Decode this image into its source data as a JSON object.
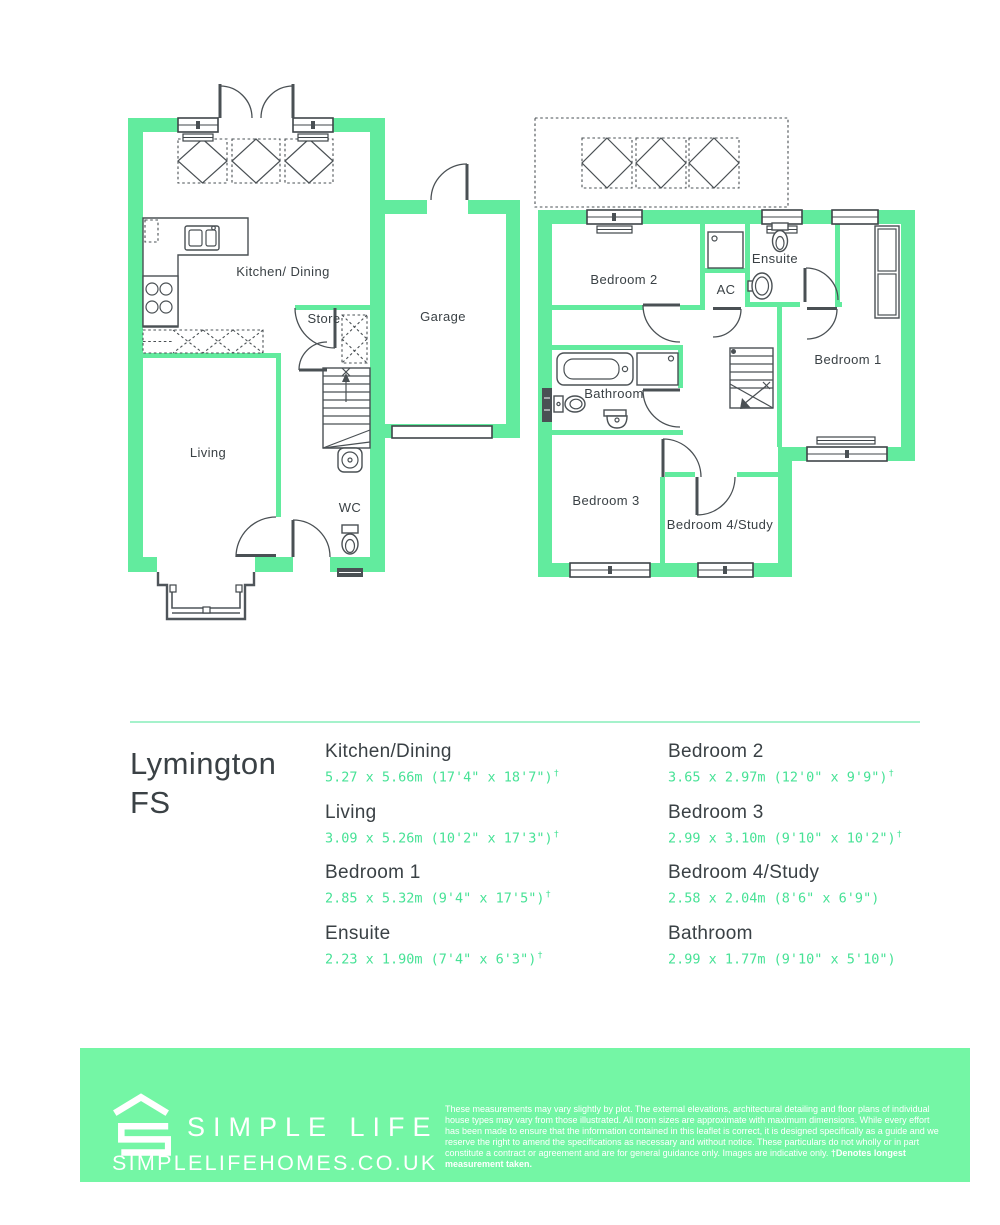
{
  "colors": {
    "wall_green": "#62EB9E",
    "footer_green": "#74F6A5",
    "accent_green": "#47E296",
    "divider_green": "#A5F2CB",
    "ink": "#3A4145"
  },
  "plans": {
    "ground": {
      "kitchen_dining": "Kitchen/ Dining",
      "store": "Store",
      "garage": "Garage",
      "living": "Living",
      "wc": "WC"
    },
    "first": {
      "bedroom2": "Bedroom 2",
      "ac": "AC",
      "ensuite": "Ensuite",
      "bedroom1": "Bedroom 1",
      "bathroom": "Bathroom",
      "bedroom3": "Bedroom 3",
      "bedroom4": "Bedroom 4/Study"
    }
  },
  "title": {
    "line1": "Lymington",
    "line2": "FS"
  },
  "rooms": {
    "col1": [
      {
        "name": "Kitchen/Dining",
        "size": "5.27 x 5.66m (17'4\" x 18'7\")",
        "note": "†"
      },
      {
        "name": "Living",
        "size": "3.09 x 5.26m (10'2\" x 17'3\")",
        "note": "†"
      },
      {
        "name": "Bedroom 1",
        "size": "2.85 x 5.32m (9'4\" x 17'5\")",
        "note": "†"
      },
      {
        "name": "Ensuite",
        "size": "2.23 x 1.90m (7'4\" x 6'3\")",
        "note": "†"
      }
    ],
    "col2": [
      {
        "name": "Bedroom 2",
        "size": "3.65 x 2.97m (12'0\" x 9'9\")",
        "note": "†"
      },
      {
        "name": "Bedroom 3",
        "size": "2.99 x 3.10m (9'10\" x 10'2\")",
        "note": "†"
      },
      {
        "name": "Bedroom 4/Study",
        "size": "2.58 x 2.04m (8'6\" x 6'9\")",
        "note": ""
      },
      {
        "name": "Bathroom",
        "size": "2.99 x 1.77m (9'10\" x 5'10\")",
        "note": ""
      }
    ]
  },
  "footer": {
    "brand": "SIMPLE LIFE",
    "url": "SIMPLELIFEHOMES.CO.UK",
    "disclaimer": "These measurements may vary slightly by plot. The external elevations, architectural detailing and floor plans of individual house types may vary from those illustrated. All room sizes are approximate with maximum dimensions. While every effort has been made to ensure that the information contained in this leaflet is correct, it is designed specifically as a guide and we reserve the right to amend the specifications as necessary and without notice. These particulars do not wholly or in part constitute a contract or agreement and are for general guidance only. Images are indicative only. ",
    "disclaimer_bold": "†Denotes longest measurement taken."
  }
}
